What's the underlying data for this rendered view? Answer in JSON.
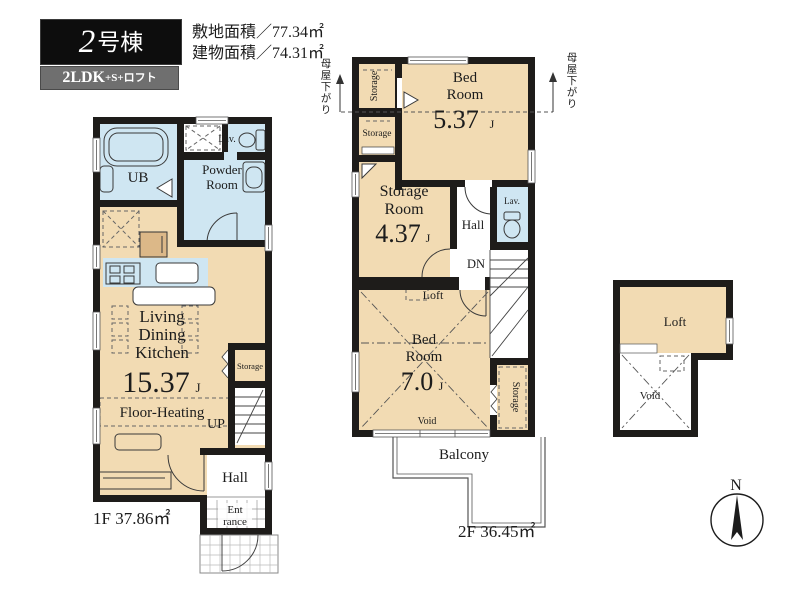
{
  "header": {
    "unit_number": "2",
    "unit_suffix": "号棟",
    "plan_main": "2LDK",
    "plan_sub": "+S+ロフト",
    "site_area": "敷地面積／77.34㎡",
    "building_area": "建物面積／74.31㎡"
  },
  "floor1": {
    "footer": "1F 37.86㎡",
    "ub": "UB",
    "lav": "Lav.",
    "powder1": "Powder",
    "powder2": "Room",
    "ldk1": "Living",
    "ldk2": "Dining",
    "ldk3": "Kitchen",
    "ldk_size": "15.37",
    "ldk_unit": "J",
    "floor_heating": "Floor-Heating",
    "storage": "Storage",
    "up": "UP",
    "hall": "Hall",
    "ent1": "Ent",
    "ent2": "rance"
  },
  "floor2": {
    "footer": "2F 36.45㎡",
    "storage_top": "Storage",
    "storage_mid": "Storage",
    "bed1_a": "Bed",
    "bed1_b": "Room",
    "bed1_size": "5.37",
    "bed1_unit": "J",
    "sroom_a": "Storage",
    "sroom_b": "Room",
    "sroom_size": "4.37",
    "sroom_unit": "J",
    "hall": "Hall",
    "lav": "Lav.",
    "dn": "DN",
    "loft": "Loft",
    "bed2_a": "Bed",
    "bed2_b": "Room",
    "bed2_size": "7.0",
    "bed2_unit": "J",
    "void": "Void",
    "storage_right": "Storage",
    "balcony": "Balcony",
    "eaves_left": "母屋下がり",
    "eaves_right": "母屋下がり"
  },
  "loft_floor": {
    "loft": "Loft",
    "void": "Void"
  },
  "compass": {
    "north": "N"
  },
  "colors": {
    "room_tan": "#f2dbb3",
    "room_blue": "#cfe6f2",
    "wall": "#1e1c1a",
    "badge_black": "#0d0d0d",
    "badge_gray": "#6f6f6f"
  }
}
